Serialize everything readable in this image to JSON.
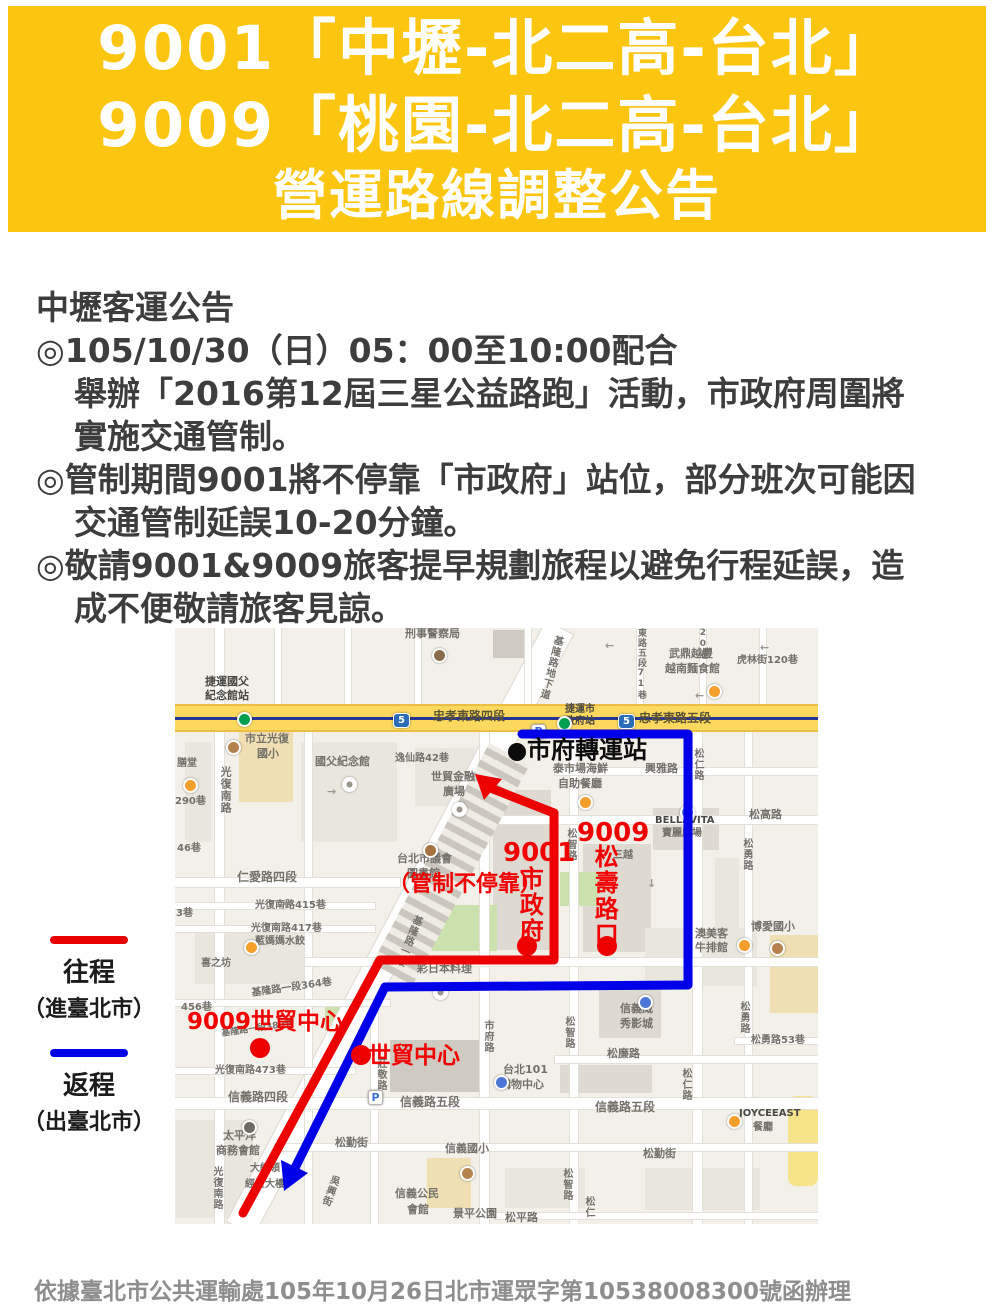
{
  "banner": {
    "bg": "#FCC50F",
    "fg": "#FFFFFF",
    "lines": [
      "9001「中壢-北二高-台北」",
      "9009「桃園-北二高-台北」",
      "營運路線調整公告"
    ]
  },
  "notice": {
    "lines": [
      {
        "text": "中壢客運公告",
        "indent": 0
      },
      {
        "text": "◎105/10/30（日）05：00至10:00配合",
        "indent": 0
      },
      {
        "text": "舉辦「2016第12屆三星公益路跑」活動，市政府周圍將",
        "indent": 1
      },
      {
        "text": "實施交通管制。",
        "indent": 1
      },
      {
        "text": "◎管制期間9001將不停靠「市政府」站位，部分班次可能因",
        "indent": 0
      },
      {
        "text": "交通管制延誤10-20分鐘。",
        "indent": 1
      },
      {
        "text": "◎敬請9001&9009旅客提早規劃旅程以避免行程延誤，造",
        "indent": 0
      },
      {
        "text": "成不便敬請旅客見諒。",
        "indent": 1
      }
    ]
  },
  "legend": {
    "outbound_label": "往程",
    "outbound_sub": "（進臺北市）",
    "outbound_color": "#E60000",
    "return_label": "返程",
    "return_sub": "（出臺北市）",
    "return_color": "#0000E8"
  },
  "map": {
    "colors": {
      "base": "#F3F0E9",
      "route_inbound": "#ED0000",
      "route_return": "#0000E8",
      "highway_road": "#FBD95E",
      "mrt_line": "#283593"
    },
    "blocks": [
      {
        "x": 318,
        "y": 2,
        "w": 38,
        "h": 28,
        "c": "bld3"
      },
      {
        "x": 10,
        "y": 114,
        "w": 26,
        "h": 100,
        "c": "bld"
      },
      {
        "x": 64,
        "y": 90,
        "w": 54,
        "h": 84,
        "c": "tan"
      },
      {
        "x": 126,
        "y": 114,
        "w": 96,
        "h": 100,
        "c": "bld"
      },
      {
        "x": 240,
        "y": 120,
        "w": 60,
        "h": 58,
        "c": "bld"
      },
      {
        "x": 318,
        "y": 162,
        "w": 58,
        "h": 160,
        "c": "bld2"
      },
      {
        "x": 408,
        "y": 216,
        "w": 68,
        "h": 108,
        "c": "bld2"
      },
      {
        "x": 478,
        "y": 180,
        "w": 66,
        "h": 42,
        "c": "bld2"
      },
      {
        "x": 540,
        "y": 230,
        "w": 24,
        "h": 90,
        "c": "bld"
      },
      {
        "x": 20,
        "y": 300,
        "w": 110,
        "h": 56,
        "c": "bld"
      },
      {
        "x": 385,
        "y": 244,
        "w": 38,
        "h": 34,
        "c": "green"
      },
      {
        "x": 250,
        "y": 277,
        "w": 72,
        "h": 46,
        "c": "green"
      },
      {
        "x": 150,
        "y": 377,
        "w": 36,
        "h": 26,
        "c": "green"
      },
      {
        "x": 215,
        "y": 412,
        "w": 92,
        "h": 52,
        "c": "bld3"
      },
      {
        "x": 424,
        "y": 360,
        "w": 62,
        "h": 50,
        "c": "bld2"
      },
      {
        "x": 385,
        "y": 437,
        "w": 92,
        "h": 28,
        "c": "bld2"
      },
      {
        "x": 595,
        "y": 307,
        "w": 48,
        "h": 78,
        "c": "tan"
      },
      {
        "x": 252,
        "y": 530,
        "w": 44,
        "h": 50,
        "c": "tan"
      },
      {
        "x": 470,
        "y": 300,
        "w": 112,
        "h": 58,
        "c": "bld"
      },
      {
        "x": 330,
        "y": 540,
        "w": 80,
        "h": 40,
        "c": "bld"
      },
      {
        "x": 470,
        "y": 540,
        "w": 115,
        "h": 42,
        "c": "bld"
      },
      {
        "x": 0,
        "y": 492,
        "w": 78,
        "h": 98,
        "c": "bld"
      },
      {
        "x": 613,
        "y": 468,
        "w": 30,
        "h": 90,
        "c": "yel"
      }
    ],
    "streets": [
      {
        "x": 40,
        "y": 0,
        "w": 9,
        "h": 596
      },
      {
        "x": 100,
        "y": 0,
        "w": 6,
        "h": 76
      },
      {
        "x": 170,
        "y": 0,
        "w": 6,
        "h": 76
      },
      {
        "x": 240,
        "y": 0,
        "w": 6,
        "h": 76
      },
      {
        "x": 350,
        "y": 0,
        "w": 6,
        "h": 76
      },
      {
        "x": 462,
        "y": 0,
        "w": 6,
        "h": 76
      },
      {
        "x": 525,
        "y": 0,
        "w": 6,
        "h": 76
      },
      {
        "x": 585,
        "y": 0,
        "w": 6,
        "h": 76
      },
      {
        "x": 130,
        "y": 104,
        "w": 7,
        "h": 492
      },
      {
        "x": 196,
        "y": 380,
        "w": 7,
        "h": 216
      },
      {
        "x": 305,
        "y": 104,
        "w": 9,
        "h": 492
      },
      {
        "x": 395,
        "y": 104,
        "w": 8,
        "h": 492
      },
      {
        "x": 518,
        "y": 104,
        "w": 9,
        "h": 492
      },
      {
        "x": 570,
        "y": 104,
        "w": 7,
        "h": 492
      },
      {
        "x": 380,
        "y": 140,
        "w": 263,
        "h": 7
      },
      {
        "x": 310,
        "y": 188,
        "w": 333,
        "h": 8
      },
      {
        "x": 130,
        "y": 330,
        "w": 513,
        "h": 8
      },
      {
        "x": 0,
        "y": 250,
        "w": 225,
        "h": 9
      },
      {
        "x": 0,
        "y": 275,
        "w": 200,
        "h": 6
      },
      {
        "x": 0,
        "y": 298,
        "w": 200,
        "h": 6
      },
      {
        "x": 0,
        "y": 372,
        "w": 215,
        "h": 6
      },
      {
        "x": 0,
        "y": 440,
        "w": 180,
        "h": 6
      },
      {
        "x": 0,
        "y": 470,
        "w": 643,
        "h": 11
      },
      {
        "x": 100,
        "y": 516,
        "w": 543,
        "h": 7
      },
      {
        "x": 380,
        "y": 428,
        "w": 263,
        "h": 7
      },
      {
        "x": 560,
        "y": 410,
        "w": 83,
        "h": 6
      },
      {
        "x": 320,
        "y": 585,
        "w": 323,
        "h": 6
      }
    ],
    "street_labels": [
      {
        "t": "刑事警察局",
        "x": 230,
        "y": 0,
        "s": 11
      },
      {
        "t": "捷運國父",
        "x": 30,
        "y": 48,
        "s": 11,
        "b": 1
      },
      {
        "t": "紀念館站",
        "x": 30,
        "y": 62,
        "s": 11,
        "b": 1
      },
      {
        "t": "市立光復",
        "x": 70,
        "y": 105,
        "s": 11
      },
      {
        "t": "國小",
        "x": 82,
        "y": 120,
        "s": 11
      },
      {
        "t": "國父紀念館",
        "x": 140,
        "y": 128,
        "s": 11
      },
      {
        "t": "逸仙路42巷",
        "x": 220,
        "y": 125,
        "s": 10
      },
      {
        "t": "世貿金融",
        "x": 256,
        "y": 143,
        "s": 11
      },
      {
        "t": "廣場",
        "x": 268,
        "y": 158,
        "s": 11
      },
      {
        "t": "光復南路",
        "x": 44,
        "y": 138,
        "s": 11,
        "v": 1
      },
      {
        "t": "膳堂",
        "x": 2,
        "y": 130,
        "s": 10
      },
      {
        "t": "290巷",
        "x": 0,
        "y": 168,
        "s": 10
      },
      {
        "t": "46巷",
        "x": 2,
        "y": 215,
        "s": 10
      },
      {
        "t": "3巷",
        "x": 1,
        "y": 280,
        "s": 10
      },
      {
        "t": "仁愛路四段",
        "x": 62,
        "y": 243,
        "s": 12
      },
      {
        "t": "光復南路415巷",
        "x": 80,
        "y": 272,
        "s": 10
      },
      {
        "t": "光復南路417巷",
        "x": 76,
        "y": 295,
        "s": 10
      },
      {
        "t": "藍媽媽水餃",
        "x": 80,
        "y": 308,
        "s": 10
      },
      {
        "t": "喜之坊",
        "x": 26,
        "y": 330,
        "s": 10
      },
      {
        "t": "456巷",
        "x": 6,
        "y": 374,
        "s": 10
      },
      {
        "t": "基隆路一段364巷",
        "x": 76,
        "y": 360,
        "s": 10,
        "r": -8
      },
      {
        "t": "基隆路一段380巷",
        "x": 46,
        "y": 402,
        "s": 9,
        "r": -8
      },
      {
        "t": "光復南路473巷",
        "x": 40,
        "y": 437,
        "s": 10
      },
      {
        "t": "信義路四段",
        "x": 53,
        "y": 463,
        "s": 12
      },
      {
        "t": "信義路五段",
        "x": 225,
        "y": 468,
        "s": 12
      },
      {
        "t": "信義路五段",
        "x": 420,
        "y": 473,
        "s": 12
      },
      {
        "t": "莊敬路",
        "x": 200,
        "y": 430,
        "s": 10,
        "v": 1
      },
      {
        "t": "吳興街",
        "x": 155,
        "y": 545,
        "s": 10,
        "v": 1,
        "r": 20
      },
      {
        "t": "太平洋",
        "x": 48,
        "y": 502,
        "s": 11
      },
      {
        "t": "商務會館",
        "x": 41,
        "y": 517,
        "s": 11
      },
      {
        "t": "大統領",
        "x": 75,
        "y": 535,
        "s": 10
      },
      {
        "t": "經貿大樓",
        "x": 70,
        "y": 551,
        "s": 10
      },
      {
        "t": "光復南路",
        "x": 36,
        "y": 538,
        "s": 10,
        "v": 1
      },
      {
        "t": "松勤街",
        "x": 160,
        "y": 509,
        "s": 11
      },
      {
        "t": "信義國小",
        "x": 270,
        "y": 515,
        "s": 11
      },
      {
        "t": "信義公民",
        "x": 220,
        "y": 560,
        "s": 11
      },
      {
        "t": "會館",
        "x": 232,
        "y": 576,
        "s": 11
      },
      {
        "t": "景平公園",
        "x": 278,
        "y": 580,
        "s": 11
      },
      {
        "t": "松平路",
        "x": 330,
        "y": 584,
        "s": 11
      },
      {
        "t": "松勤街",
        "x": 468,
        "y": 520,
        "s": 11
      },
      {
        "t": "松智路",
        "x": 386,
        "y": 540,
        "s": 10,
        "v": 1
      },
      {
        "t": "松智路",
        "x": 388,
        "y": 388,
        "s": 10,
        "v": 1
      },
      {
        "t": "松智路",
        "x": 390,
        "y": 200,
        "s": 10,
        "v": 1
      },
      {
        "t": "市府路",
        "x": 307,
        "y": 392,
        "s": 10,
        "v": 1
      },
      {
        "t": "基隆路一段",
        "x": 238,
        "y": 285,
        "s": 10,
        "v": 1,
        "r": 22
      },
      {
        "t": "彩日本料理",
        "x": 242,
        "y": 335,
        "s": 11
      },
      {
        "t": "台北市議會",
        "x": 222,
        "y": 225,
        "s": 11
      },
      {
        "t": "圖書館",
        "x": 232,
        "y": 240,
        "s": 11
      },
      {
        "t": "泰市場海鮮",
        "x": 378,
        "y": 135,
        "s": 11
      },
      {
        "t": "自助餐廳",
        "x": 383,
        "y": 150,
        "s": 11
      },
      {
        "t": "興雅路",
        "x": 470,
        "y": 135,
        "s": 11
      },
      {
        "t": "松仁路",
        "x": 517,
        "y": 120,
        "s": 10,
        "v": 1
      },
      {
        "t": "BELLAVITA",
        "x": 480,
        "y": 187,
        "s": 10,
        "b": 1
      },
      {
        "t": "寶麗廣場",
        "x": 487,
        "y": 200,
        "s": 10
      },
      {
        "t": "松高路",
        "x": 574,
        "y": 181,
        "s": 11
      },
      {
        "t": "松勇路",
        "x": 566,
        "y": 210,
        "s": 10,
        "v": 1
      },
      {
        "t": "三越",
        "x": 438,
        "y": 222,
        "s": 10
      },
      {
        "t": "武鼎越豐",
        "x": 494,
        "y": 20,
        "s": 11
      },
      {
        "t": "越南麵食館",
        "x": 490,
        "y": 35,
        "s": 11
      },
      {
        "t": "虎林街120巷",
        "x": 562,
        "y": 27,
        "s": 10
      },
      {
        "t": "東路五段71巷",
        "x": 460,
        "y": 0,
        "s": 9,
        "v": 1
      },
      {
        "t": "20巷",
        "x": 522,
        "y": 0,
        "s": 9,
        "v": 1
      },
      {
        "t": "基隆路地下道",
        "x": 378,
        "y": 6,
        "s": 10,
        "v": 1,
        "r": 14
      },
      {
        "t": "忠孝東路四段",
        "x": 258,
        "y": 82,
        "s": 12,
        "dark": 1
      },
      {
        "t": "忠孝東路五段",
        "x": 464,
        "y": 84,
        "s": 12,
        "dark": 1
      },
      {
        "t": "捷運市",
        "x": 390,
        "y": 76,
        "s": 10,
        "b": 1
      },
      {
        "t": "政府站",
        "x": 390,
        "y": 88,
        "s": 10,
        "b": 1
      },
      {
        "t": "澳美客",
        "x": 520,
        "y": 300,
        "s": 11
      },
      {
        "t": "牛排館",
        "x": 520,
        "y": 314,
        "s": 11
      },
      {
        "t": "博愛國小",
        "x": 576,
        "y": 293,
        "s": 11
      },
      {
        "t": "松勇路",
        "x": 563,
        "y": 373,
        "s": 10,
        "v": 1
      },
      {
        "t": "松勇路53巷",
        "x": 576,
        "y": 407,
        "s": 10
      },
      {
        "t": "松廉路",
        "x": 432,
        "y": 420,
        "s": 11
      },
      {
        "t": "信義威",
        "x": 445,
        "y": 375,
        "s": 11
      },
      {
        "t": "秀影城",
        "x": 445,
        "y": 390,
        "s": 11
      },
      {
        "t": "台北101",
        "x": 328,
        "y": 436,
        "s": 11
      },
      {
        "t": "購物中心",
        "x": 325,
        "y": 451,
        "s": 11
      },
      {
        "t": "松仁路",
        "x": 505,
        "y": 440,
        "s": 10,
        "v": 1
      },
      {
        "t": "JOYCEEAST",
        "x": 564,
        "y": 480,
        "s": 10,
        "b": 1
      },
      {
        "t": "餐廳",
        "x": 578,
        "y": 494,
        "s": 10
      },
      {
        "t": "松仁",
        "x": 408,
        "y": 568,
        "s": 10,
        "v": 1
      },
      {
        "t": "←",
        "x": 430,
        "y": 12,
        "s": 11,
        "a": 1
      },
      {
        "t": "←",
        "x": 520,
        "y": 62,
        "s": 11,
        "a": 1
      },
      {
        "t": "←",
        "x": 585,
        "y": 14,
        "s": 11,
        "a": 1
      },
      {
        "t": "→",
        "x": 152,
        "y": 158,
        "s": 11,
        "a": 1
      },
      {
        "t": "←",
        "x": 108,
        "y": 270,
        "s": 11,
        "a": 1
      },
      {
        "t": "↑",
        "x": 352,
        "y": 112,
        "s": 11,
        "a": 1
      },
      {
        "t": "↓",
        "x": 472,
        "y": 250,
        "s": 11,
        "a": 1
      }
    ],
    "icons": [
      {
        "t": "mrt",
        "x": 62,
        "y": 84
      },
      {
        "t": "mrt",
        "x": 382,
        "y": 88
      },
      {
        "t": "shield",
        "x": 218,
        "y": 85
      },
      {
        "t": "shield",
        "x": 443,
        "y": 86
      },
      {
        "t": "p",
        "x": 356,
        "y": 96
      },
      {
        "t": "p",
        "x": 193,
        "y": 462
      },
      {
        "t": "rest",
        "x": 8,
        "y": 150
      },
      {
        "t": "rest",
        "x": 403,
        "y": 167
      },
      {
        "t": "rest",
        "x": 532,
        "y": 56
      },
      {
        "t": "rest",
        "x": 562,
        "y": 310
      },
      {
        "t": "rest",
        "x": 552,
        "y": 486
      },
      {
        "t": "rest",
        "x": 69,
        "y": 312
      },
      {
        "t": "school",
        "x": 51,
        "y": 112
      },
      {
        "t": "school",
        "x": 285,
        "y": 538
      },
      {
        "t": "school",
        "x": 595,
        "y": 313
      },
      {
        "t": "poi",
        "x": 167,
        "y": 149
      },
      {
        "t": "poi",
        "x": 277,
        "y": 174
      },
      {
        "t": "poi",
        "x": 258,
        "y": 357
      },
      {
        "t": "civic",
        "x": 248,
        "y": 215
      },
      {
        "t": "police",
        "x": 257,
        "y": 20
      },
      {
        "t": "movie",
        "x": 463,
        "y": 367
      },
      {
        "t": "mall",
        "x": 319,
        "y": 447
      },
      {
        "t": "mall",
        "x": 505,
        "y": 177
      },
      {
        "t": "hotel",
        "x": 67,
        "y": 492
      }
    ],
    "route_labels": [
      {
        "t": "（管制不停靠）",
        "x": 213,
        "y": 245,
        "s": 22,
        "c": "red"
      },
      {
        "t": "9001",
        "x": 328,
        "y": 212,
        "s": 26,
        "c": "red"
      },
      {
        "t": "市政府",
        "x": 341,
        "y": 238,
        "s": 24,
        "c": "red",
        "v": 1
      },
      {
        "t": "9009",
        "x": 402,
        "y": 192,
        "s": 26,
        "c": "red"
      },
      {
        "t": "松壽路口",
        "x": 416,
        "y": 216,
        "s": 24,
        "c": "red",
        "v": 1
      },
      {
        "t": "9009世貿中心",
        "x": 12,
        "y": 382,
        "s": 23,
        "c": "red"
      },
      {
        "t": "世貿中心",
        "x": 193,
        "y": 416,
        "s": 23,
        "c": "red"
      },
      {
        "t": "市府轉運站",
        "x": 352,
        "y": 110,
        "s": 24,
        "c": "black"
      }
    ],
    "stops": [
      {
        "name": "9001-shizhengfu",
        "x": 352,
        "y": 318
      },
      {
        "name": "9009-songshou-intersection",
        "x": 432,
        "y": 318
      },
      {
        "name": "9009-world-trade-center",
        "x": 85,
        "y": 420
      },
      {
        "name": "world-trade-center",
        "x": 186,
        "y": 427
      }
    ],
    "transfer_station_dot": {
      "x": 342,
      "y": 124
    }
  },
  "footer": {
    "text": "依據臺北市公共運輸處105年10月26日北市運眾字第10538008300號函辦理"
  }
}
